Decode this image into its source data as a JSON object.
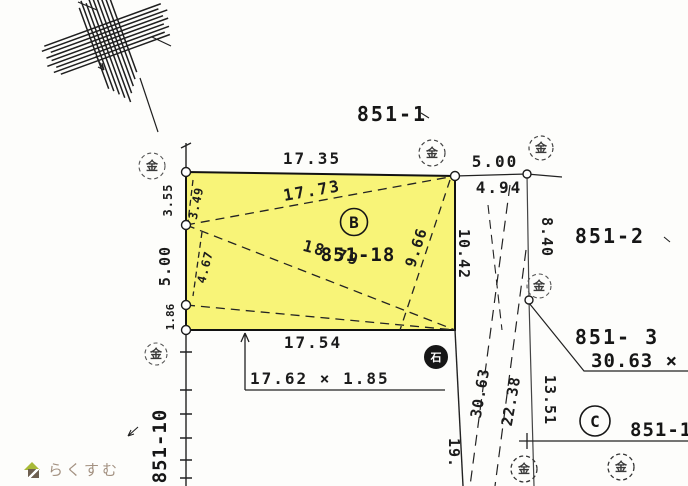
{
  "watermark": {
    "brand": "らくすむ"
  },
  "region_labels": {
    "top": "851-1",
    "right": "851-2",
    "right_lower": "851- 3",
    "right_lower_size": "30.63 × 1.",
    "bottom_right": "851-19",
    "bottom_right_letter": "C",
    "left_bottom": "851-10"
  },
  "main_parcel": {
    "letter": "B",
    "number": "851-18",
    "fill_color": "#f8f478"
  },
  "dimensions": {
    "top_edge": "17.35",
    "top_diagonal": "17.73",
    "upper_right_out": "5.00",
    "upper_right_in": "4.94",
    "left_top": "3.55",
    "left_top_diag": "3.49",
    "left_mid": "5.00",
    "left_mid_diag": "4.67",
    "left_bottom": "1.86",
    "long_diagonal": "18.79",
    "inner_diagonal": "9.66",
    "right_edge": "10.42",
    "right_offset": "8.40",
    "bottom_edge": "17.54",
    "bottom_strip": "17.62 × 1.85",
    "dash_line_long": "30.63",
    "dash_line_short": "22.38",
    "right_lower_seg": "13.51",
    "bottom_partial": "19."
  },
  "markers": {
    "metal_glyph": "金",
    "stone_glyph": "石"
  }
}
